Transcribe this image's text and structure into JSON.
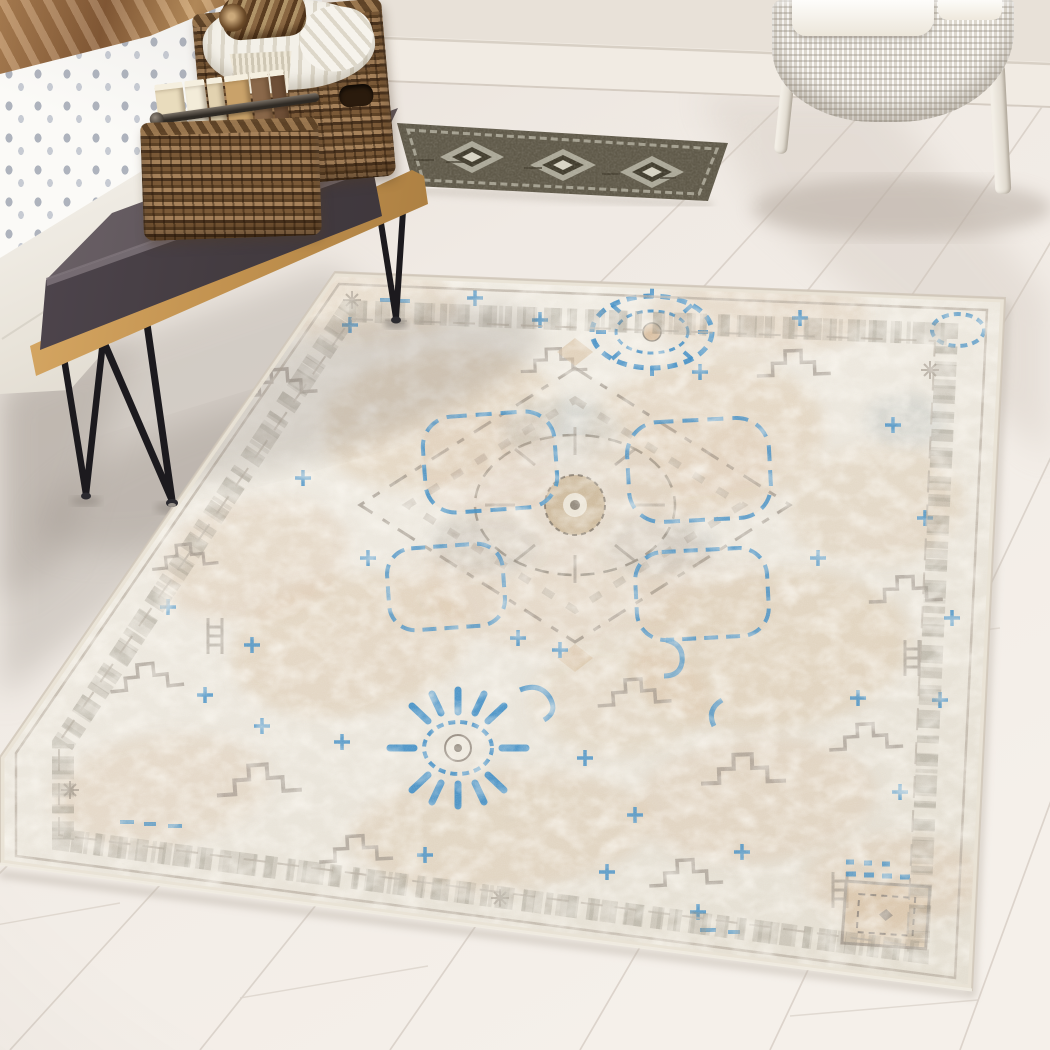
{
  "scene": {
    "alt": "Bedroom scene photographed from above: a large distressed ivory, beige and blue vintage-medallion area rug on a whitewashed plank floor, with a bed, a gold bench with charcoal cushion and wicker baskets at left, a small dark runner rug and a white wicker armchair at top",
    "objects": [
      {
        "name": "bed",
        "parts": [
          "copper-satin-blanket",
          "gray-dotted-duvet",
          "white-platform"
        ]
      },
      {
        "name": "storage-bench",
        "parts": [
          "charcoal-cushion",
          "gold-frame",
          "black-hairpin-legs"
        ]
      },
      {
        "name": "wicker-baskets",
        "parts": [
          "large-basket",
          "small-basket",
          "chunky-knit-throw",
          "rolled-mat",
          "books",
          "metal-handle-bar"
        ]
      },
      {
        "name": "runner-rug",
        "style": "dark-olive-diamond-runner"
      },
      {
        "name": "area-rug",
        "style": "distressed-heriz-medallion",
        "accents": [
          "blue-ring-medallion",
          "blue-starburst",
          "blue-cartouches",
          "greek-key-border",
          "corner-square"
        ]
      },
      {
        "name": "wicker-armchair",
        "parts": [
          "white-weave-body",
          "white-cushion",
          "legs"
        ]
      },
      {
        "name": "room",
        "parts": [
          "cream-wall",
          "baseboard",
          "whitewashed-plank-floor"
        ]
      }
    ]
  },
  "palette": {
    "wall": "#e8e1d8",
    "baseboard": "#f1ebe3",
    "floor_top": "#e9e2da",
    "floor_main": "#f1ebe5",
    "floor_light": "#f5f0ea",
    "seam": "#d6cdc4",
    "floor_gray": "#b7b0a8",
    "rug_ivory": "#ebe6db",
    "rug_cream": "#f3efe6",
    "rug_tan": "#d7bd9e",
    "rug_taupe": "#968d82",
    "rug_blue": "#3e8dc5",
    "runner_base": "#5f5949",
    "runner_light": "#b4b0a1",
    "runner_dark": "#413c2d",
    "runner_cream": "#d8d4c4",
    "bench_gold": "#c79a58",
    "cushion_top": "#655c61",
    "cushion_front": "#483f44",
    "leg_black": "#1c1a1e",
    "basket_mid": "#7a5937",
    "basket_dark": "#4a331e",
    "basket_light": "#a5815a",
    "knit_white": "#f3f0e8",
    "book_cream": "#e9dcbd",
    "book_tan": "#c9a26a",
    "chair_body": "#f2eee6",
    "blanket_copper": "#a97a4e",
    "duvet_dot": "#aeb3bd",
    "shadow": "#8d847b"
  }
}
